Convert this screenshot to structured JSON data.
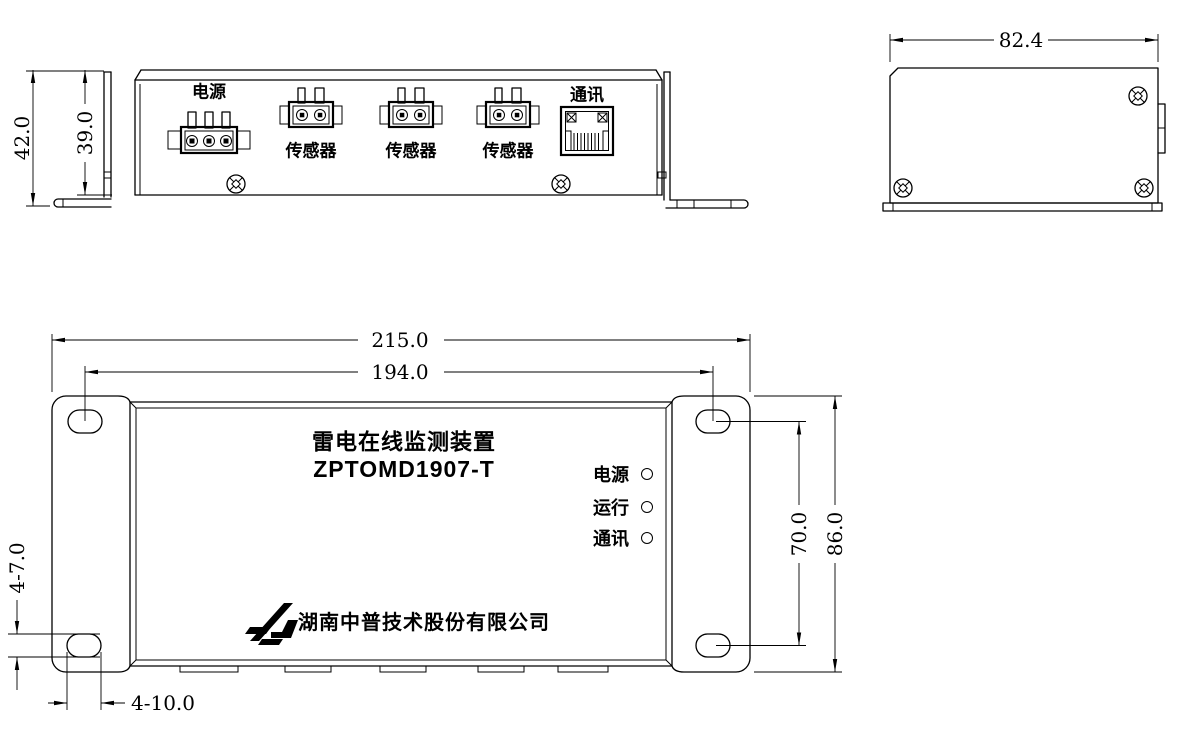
{
  "drawing": {
    "views": {
      "front": {
        "dim_total_height": "42.0",
        "dim_body_height": "39.0",
        "power_label": "电源",
        "comm_label": "通讯",
        "sensor_labels": [
          "传感器",
          "传感器",
          "传感器"
        ]
      },
      "side": {
        "dim_width": "82.4"
      },
      "top": {
        "dim_total_width": "215.0",
        "dim_hole_span_h": "194.0",
        "dim_total_height": "86.0",
        "dim_hole_span_v": "70.0",
        "dim_hole_height": "4-7.0",
        "dim_hole_width": "4-10.0",
        "device_title": "雷电在线监测装置",
        "device_model": "ZPTOMD1907-T",
        "leds": [
          {
            "label": "电源"
          },
          {
            "label": "运行"
          },
          {
            "label": "通讯"
          }
        ],
        "company": "湖南中普技术股份有限公司"
      }
    },
    "colors": {
      "line": "#000000",
      "background": "#ffffff"
    }
  }
}
